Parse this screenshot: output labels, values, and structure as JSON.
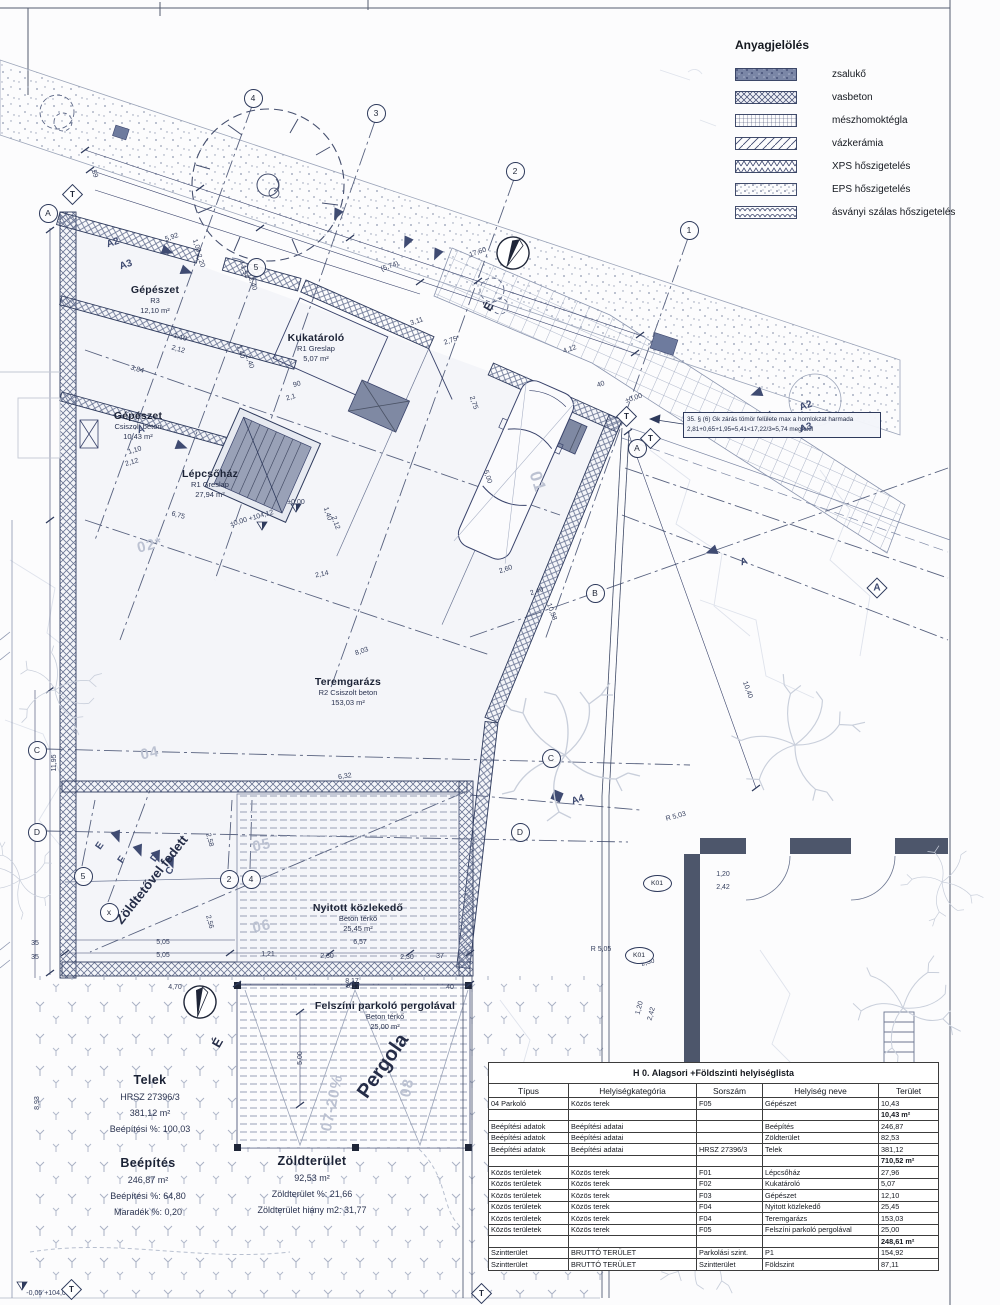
{
  "colors": {
    "ink": "#2e3a5c",
    "navy": "#3f4b72",
    "faint": "#c9cfdb",
    "paper": "#fcfcfd",
    "gray_fill": "#7f89a3"
  },
  "legend": {
    "title": "Anyagjelölés",
    "items": [
      {
        "key": "zsaluko",
        "label": "zsalukő"
      },
      {
        "key": "vasbeton",
        "label": "vasbeton"
      },
      {
        "key": "meszhomok",
        "label": "mészhomoktégla"
      },
      {
        "key": "vazkeramia",
        "label": "vázkerámia"
      },
      {
        "key": "xps",
        "label": "XPS hőszigetelés"
      },
      {
        "key": "eps",
        "label": "EPS hőszigetelés"
      },
      {
        "key": "asvanyi",
        "label": "ásványi szálas hőszigetelés"
      }
    ]
  },
  "note": {
    "line1": "35. § (6) Gk zárás tömör felülete max a homlokzat harmada",
    "line2": "2,81+0,65+1,95=5,41<17,22/3=5,74 megfelel"
  },
  "table": {
    "title": "H 0. Alagsori +Földszinti helyiséglista",
    "columns": [
      "Típus",
      "Helyiségkategória",
      "Sorszám",
      "Helyiség neve",
      "Terület"
    ],
    "rows": [
      {
        "cells": [
          "04 Parkoló",
          "Közös terek",
          "F05",
          "Gépészet",
          "10,43"
        ],
        "bold": false
      },
      {
        "cells": [
          "",
          "",
          "",
          "",
          "10,43 m²"
        ],
        "bold": true
      },
      {
        "cells": [
          "Beépítési adatok",
          "Beépítési adatai",
          "",
          "Beépítés",
          "246,87"
        ],
        "bold": false
      },
      {
        "cells": [
          "Beépítési adatok",
          "Beépítési adatai",
          "",
          "Zöldterület",
          "82,53"
        ],
        "bold": false
      },
      {
        "cells": [
          "Beépítési adatok",
          "Beépítési adatai",
          "HRSZ 27396/3",
          "Telek",
          "381,12"
        ],
        "bold": false
      },
      {
        "cells": [
          "",
          "",
          "",
          "",
          "710,52 m²"
        ],
        "bold": true
      },
      {
        "cells": [
          "Közös területek",
          "Közös terek",
          "F01",
          "Lépcsőház",
          "27,96"
        ],
        "bold": false
      },
      {
        "cells": [
          "Közös területek",
          "Közös terek",
          "F02",
          "Kukatároló",
          "5,07"
        ],
        "bold": false
      },
      {
        "cells": [
          "Közös területek",
          "Közös terek",
          "F03",
          "Gépészet",
          "12,10"
        ],
        "bold": false
      },
      {
        "cells": [
          "Közös területek",
          "Közös terek",
          "F04",
          "Nyitott közlekedő",
          "25,45"
        ],
        "bold": false
      },
      {
        "cells": [
          "Közös területek",
          "Közös terek",
          "F04",
          "Teremgarázs",
          "153,03"
        ],
        "bold": false
      },
      {
        "cells": [
          "Közös területek",
          "Közös terek",
          "F05",
          "Felszíni parkoló pergolával",
          "25,00"
        ],
        "bold": false
      },
      {
        "cells": [
          "",
          "",
          "",
          "",
          "248,61 m²"
        ],
        "bold": true
      },
      {
        "cells": [
          "Szintterület",
          "BRUTTÓ TERÜLET",
          "Parkolási szint.",
          "P1",
          "154,92"
        ],
        "bold": false
      },
      {
        "cells": [
          "Szintterület",
          "BRUTTÓ TERÜLET",
          "Szintterület",
          "Földszint",
          "87,11"
        ],
        "bold": false
      }
    ]
  },
  "plan": {
    "rooms": [
      {
        "title": "Gépészet",
        "lines": [
          "R3",
          "12,10 m²"
        ],
        "x": 155,
        "y": 300,
        "r": 0
      },
      {
        "title": "Kukatároló",
        "lines": [
          "R1 Greslap",
          "5,07 m²"
        ],
        "x": 316,
        "y": 348,
        "r": 0
      },
      {
        "title": "Gépészet",
        "lines": [
          "Csiszolt beton",
          "10,43 m²"
        ],
        "x": 138,
        "y": 426,
        "r": 0
      },
      {
        "title": "Lépcsőház",
        "lines": [
          "R1 Greslap",
          "27,94 m²"
        ],
        "x": 210,
        "y": 484,
        "r": 0
      },
      {
        "title": "Teremgarázs",
        "lines": [
          "R2 Csiszolt beton",
          "153,03 m²"
        ],
        "x": 348,
        "y": 692,
        "r": 0
      },
      {
        "title": "Nyitott közlekedő",
        "lines": [
          "Beton térkő",
          "25,45 m²"
        ],
        "x": 358,
        "y": 918,
        "r": 0
      },
      {
        "title": "Felszíni parkoló pergolával",
        "lines": [
          "Beton térkő",
          "25,00 m²"
        ],
        "x": 385,
        "y": 1016,
        "r": 0
      }
    ],
    "stats": [
      {
        "title": "Telek",
        "lines": [
          "HRSZ 27396/3",
          "381,12 m²",
          "Beépítési %: 100,03"
        ],
        "x": 150,
        "y": 1105
      },
      {
        "title": "Beépítés",
        "lines": [
          "246,87 m²",
          "Beépítési %: 64,80",
          "Maradék %: 0,20"
        ],
        "x": 148,
        "y": 1188
      },
      {
        "title": "Zöldterület",
        "lines": [
          "92,53 m²",
          "Zöldterület %: 21,66",
          "Zöldterület hiány m2: 31,77"
        ],
        "x": 312,
        "y": 1186
      }
    ],
    "dims": [
      {
        "t": "5,92",
        "x": 172,
        "y": 238,
        "r": -19
      },
      {
        "t": "17,60",
        "x": 478,
        "y": 253,
        "r": -19
      },
      {
        "t": "(5,74)",
        "x": 390,
        "y": 267,
        "r": -19
      },
      {
        "t": "3,11",
        "x": 417,
        "y": 322,
        "r": -19
      },
      {
        "t": "2,75*",
        "x": 452,
        "y": 341,
        "r": -19
      },
      {
        "t": "4,12",
        "x": 570,
        "y": 350,
        "r": -19
      },
      {
        "t": "40",
        "x": 601,
        "y": 385,
        "r": -19
      },
      {
        "t": "±0,00",
        "x": 634,
        "y": 399,
        "r": -19
      },
      {
        "t": "90",
        "x": 297,
        "y": 385,
        "r": -16
      },
      {
        "t": "2,1",
        "x": 291,
        "y": 398,
        "r": -16
      },
      {
        "t": "3,84",
        "x": 137,
        "y": 370,
        "r": 16
      },
      {
        "t": "1,10",
        "x": 180,
        "y": 338,
        "r": 16
      },
      {
        "t": "2,12",
        "x": 178,
        "y": 350,
        "r": 16
      },
      {
        "t": "1,00",
        "x": 196,
        "y": 246,
        "r": 71
      },
      {
        "t": "2,20",
        "x": 200,
        "y": 261,
        "r": 71
      },
      {
        "t": "1,54",
        "x": 244,
        "y": 272,
        "r": 71
      },
      {
        "t": "2,40",
        "x": 252,
        "y": 284,
        "r": 71
      },
      {
        "t": "1,40",
        "x": 240,
        "y": 352,
        "r": 71
      },
      {
        "t": "2,40",
        "x": 249,
        "y": 362,
        "r": 71
      },
      {
        "t": "59",
        "x": 94,
        "y": 174,
        "r": 71
      },
      {
        "t": "1,10",
        "x": 135,
        "y": 451,
        "r": -16
      },
      {
        "t": "2,12",
        "x": 132,
        "y": 463,
        "r": -16
      },
      {
        "t": "6,75",
        "x": 178,
        "y": 516,
        "r": 16
      },
      {
        "t": "1,40",
        "x": 327,
        "y": 514,
        "r": 71
      },
      {
        "t": "2,12",
        "x": 335,
        "y": 523,
        "r": 71
      },
      {
        "t": "5,00",
        "x": 487,
        "y": 477,
        "r": 71
      },
      {
        "t": "2,75",
        "x": 473,
        "y": 403,
        "r": 71
      },
      {
        "t": "2,60",
        "x": 506,
        "y": 570,
        "r": -19
      },
      {
        "t": "2,40",
        "x": 537,
        "y": 592,
        "r": -19
      },
      {
        "t": "2,14",
        "x": 322,
        "y": 575,
        "r": -12
      },
      {
        "t": "8,03",
        "x": 362,
        "y": 652,
        "r": -19
      },
      {
        "t": "6,32",
        "x": 345,
        "y": 777,
        "r": -8
      },
      {
        "t": "10,58",
        "x": 551,
        "y": 612,
        "r": 70
      },
      {
        "t": "10,40",
        "x": 747,
        "y": 690,
        "r": 70
      },
      {
        "t": "6,57",
        "x": 360,
        "y": 943,
        "r": 0
      },
      {
        "t": "1,21",
        "x": 268,
        "y": 955,
        "r": 0
      },
      {
        "t": "2,30",
        "x": 327,
        "y": 957,
        "r": 0
      },
      {
        "t": "2,30",
        "x": 407,
        "y": 958,
        "r": 0
      },
      {
        "t": "37",
        "x": 440,
        "y": 957,
        "r": 0
      },
      {
        "t": "6,17",
        "x": 353,
        "y": 987,
        "r": 0
      },
      {
        "t": "40",
        "x": 450,
        "y": 988,
        "r": 0
      },
      {
        "t": "5,05",
        "x": 163,
        "y": 943,
        "r": 0
      },
      {
        "t": "5,05",
        "x": 163,
        "y": 956,
        "r": 0
      },
      {
        "t": "2,56",
        "x": 209,
        "y": 922,
        "r": 75
      },
      {
        "t": "2,58",
        "x": 209,
        "y": 840,
        "r": 75
      },
      {
        "t": "35",
        "x": 35,
        "y": 944,
        "r": 0
      },
      {
        "t": "35",
        "x": 35,
        "y": 958,
        "r": 0
      },
      {
        "t": "4,70",
        "x": 175,
        "y": 988,
        "r": 0
      },
      {
        "t": "8,17",
        "x": 352,
        "y": 982,
        "r": 0
      },
      {
        "t": "11,95",
        "x": 55,
        "y": 763,
        "r": -90
      },
      {
        "t": "8,93",
        "x": 38,
        "y": 1103,
        "r": -90
      },
      {
        "t": "1,20",
        "x": 723,
        "y": 875,
        "r": 0
      },
      {
        "t": "2,42",
        "x": 723,
        "y": 888,
        "r": 0
      },
      {
        "t": "1,20",
        "x": 640,
        "y": 1008,
        "r": -75
      },
      {
        "t": "2,42",
        "x": 652,
        "y": 1014,
        "r": -75
      },
      {
        "t": "5,00",
        "x": 301,
        "y": 1058,
        "r": -90
      },
      {
        "t": "2,30",
        "x": 648,
        "y": 963,
        "r": -15
      },
      {
        "t": "R 5,03",
        "x": 676,
        "y": 817,
        "r": -15
      },
      {
        "t": "R 5,05",
        "x": 601,
        "y": 950,
        "r": 0
      },
      {
        "t": "±0,00",
        "x": 296,
        "y": 503,
        "r": 0
      },
      {
        "t": "±0,00 +104,12",
        "x": 252,
        "y": 519,
        "r": -16
      },
      {
        "t": "-0,05 +104,07",
        "x": 48,
        "y": 1294,
        "r": 0
      }
    ],
    "parking": [
      {
        "t": "01",
        "x": 537,
        "y": 482,
        "r": 72,
        "s": 17
      },
      {
        "t": "02*",
        "x": 150,
        "y": 546,
        "r": -14,
        "s": 15
      },
      {
        "t": "04",
        "x": 150,
        "y": 754,
        "r": -12,
        "s": 15
      },
      {
        "t": "05",
        "x": 262,
        "y": 846,
        "r": -12,
        "s": 15
      },
      {
        "t": "06",
        "x": 262,
        "y": 927,
        "r": -12,
        "s": 15
      },
      {
        "t": "07-20%",
        "x": 333,
        "y": 1103,
        "r": -78,
        "s": 15
      },
      {
        "t": "08",
        "x": 408,
        "y": 1088,
        "r": -78,
        "s": 15
      }
    ],
    "bigs": [
      {
        "t": "Zöldtetővel fedett",
        "x": 152,
        "y": 880,
        "r": -52,
        "s": 13
      },
      {
        "t": "Pergola",
        "x": 383,
        "y": 1066,
        "r": -55,
        "s": 20
      },
      {
        "t": "É",
        "x": 218,
        "y": 1043,
        "r": -60,
        "s": 13
      },
      {
        "t": "É",
        "x": 489,
        "y": 307,
        "r": -60,
        "s": 12
      }
    ],
    "secs": [
      {
        "t": "A2",
        "x": 113,
        "y": 243,
        "r": -18
      },
      {
        "t": "A3",
        "x": 126,
        "y": 265,
        "r": -18
      },
      {
        "t": "A",
        "x": 141,
        "y": 430,
        "r": -18
      },
      {
        "t": "E",
        "x": 100,
        "y": 846,
        "r": -55
      },
      {
        "t": "F",
        "x": 122,
        "y": 860,
        "r": -55
      },
      {
        "t": "D",
        "x": 155,
        "y": 858,
        "r": -55
      },
      {
        "t": "C",
        "x": 170,
        "y": 871,
        "r": -55
      },
      {
        "t": "A2",
        "x": 806,
        "y": 406,
        "r": -18
      },
      {
        "t": "A3",
        "x": 806,
        "y": 428,
        "r": -18
      },
      {
        "t": "A",
        "x": 744,
        "y": 562,
        "r": -18
      },
      {
        "t": "A4",
        "x": 578,
        "y": 800,
        "r": -18
      },
      {
        "t": "A",
        "x": 877,
        "y": 588,
        "r": 0
      }
    ],
    "bubbles": [
      {
        "t": "5",
        "x": 255,
        "y": 266
      },
      {
        "t": "4",
        "x": 252,
        "y": 97
      },
      {
        "t": "3",
        "x": 375,
        "y": 112
      },
      {
        "t": "2",
        "x": 514,
        "y": 170
      },
      {
        "t": "1",
        "x": 688,
        "y": 229
      },
      {
        "t": "A",
        "x": 47,
        "y": 212
      },
      {
        "t": "C",
        "x": 36,
        "y": 749
      },
      {
        "t": "D",
        "x": 36,
        "y": 831
      },
      {
        "t": "B",
        "x": 594,
        "y": 592
      },
      {
        "t": "C",
        "x": 550,
        "y": 757
      },
      {
        "t": "D",
        "x": 519,
        "y": 831
      },
      {
        "t": "A",
        "x": 636,
        "y": 447
      },
      {
        "t": "5",
        "x": 82,
        "y": 875
      },
      {
        "t": "x",
        "x": 108,
        "y": 911
      },
      {
        "t": "2",
        "x": 228,
        "y": 878
      },
      {
        "t": "4",
        "x": 250,
        "y": 878
      }
    ],
    "ellipses": [
      {
        "t": "K01",
        "x": 656,
        "y": 882
      },
      {
        "t": "K01",
        "x": 638,
        "y": 954
      }
    ],
    "pents": [
      {
        "t": "T",
        "x": 71,
        "y": 193
      },
      {
        "t": "T",
        "x": 625,
        "y": 415
      },
      {
        "t": "T",
        "x": 649,
        "y": 437
      },
      {
        "t": "T",
        "x": 70,
        "y": 1288
      },
      {
        "t": "T",
        "x": 480,
        "y": 1292
      }
    ]
  }
}
